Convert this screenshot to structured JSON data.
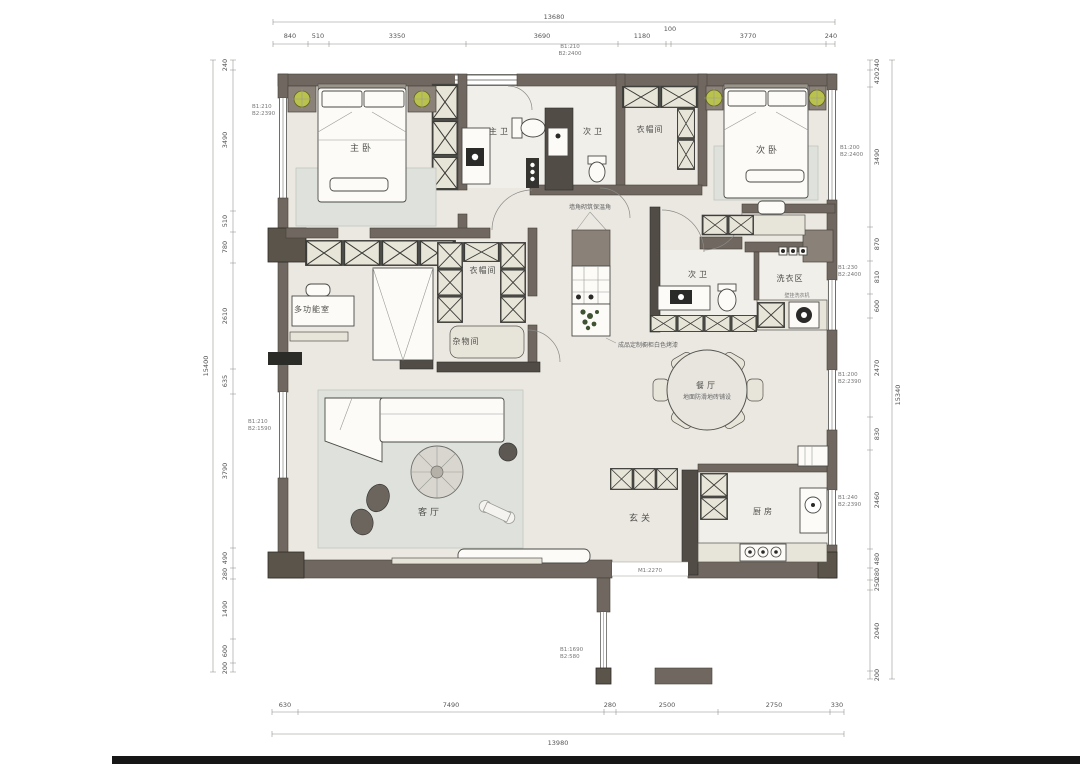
{
  "plan": {
    "rooms": {
      "master_bedroom": "主卧",
      "master_bath": "主卫",
      "second_bath_top": "次卫",
      "cloakroom_top": "衣帽间",
      "second_bedroom": "次卧",
      "multi_function": "多功能室",
      "cloakroom_mid": "衣帽间",
      "storage": "杂物间",
      "second_bath_mid": "次卫",
      "laundry": "洗衣区",
      "dining": "餐厅",
      "living": "客厅",
      "entry": "玄关",
      "kitchen": "厨房"
    },
    "notes": {
      "dining_floor": "地面防滑地砖铺设",
      "island_corner": "墙角砌筑保温角",
      "island_cabinet": "成品定制橱柜白色烤漆",
      "washer": "壁挂洗衣机",
      "entry_door": "M1:2270"
    },
    "window_tags": {
      "left_top": {
        "l1": "B1:210",
        "l2": "B2:2390"
      },
      "top_center": {
        "l1": "B1:210",
        "l2": "B2:2400"
      },
      "right_bedroom": {
        "l1": "B1:200",
        "l2": "B2:2400"
      },
      "right_mid": {
        "l1": "B1:230",
        "l2": "B2:2400"
      },
      "right_dining": {
        "l1": "B1:200",
        "l2": "B2:2390"
      },
      "right_kitchen": {
        "l1": "B1:240",
        "l2": "B2:2390"
      },
      "left_lower": {
        "l1": "B1:210",
        "l2": "B2:1590"
      },
      "bottom_ext": {
        "l1": "B1:1690",
        "l2": "B2:580"
      }
    },
    "dimensions": {
      "top": {
        "total": "13680",
        "segments": [
          "840",
          "510",
          "3350",
          "3690",
          "1180",
          "100",
          "3770",
          "240"
        ]
      },
      "bottom": {
        "total": "13980",
        "segments": [
          "630",
          "7490",
          "280",
          "2500",
          "2750",
          "330"
        ]
      },
      "left": {
        "total": "15400",
        "segments": [
          "240",
          "3490",
          "510",
          "780",
          "2610",
          "635",
          "3790",
          "490",
          "280",
          "1490",
          "600",
          "200"
        ]
      },
      "right": {
        "total": "15340",
        "segments": [
          "240",
          "420",
          "3490",
          "870",
          "810",
          "600",
          "2470",
          "830",
          "2460",
          "480",
          "280",
          "250",
          "2040",
          "200"
        ]
      }
    },
    "colors": {
      "wall": "#6f6760",
      "wall_dark": "#514c46",
      "floor": "#ebe8e2",
      "rug": "#dfe2dc",
      "lamp": "#b9c24d"
    }
  }
}
